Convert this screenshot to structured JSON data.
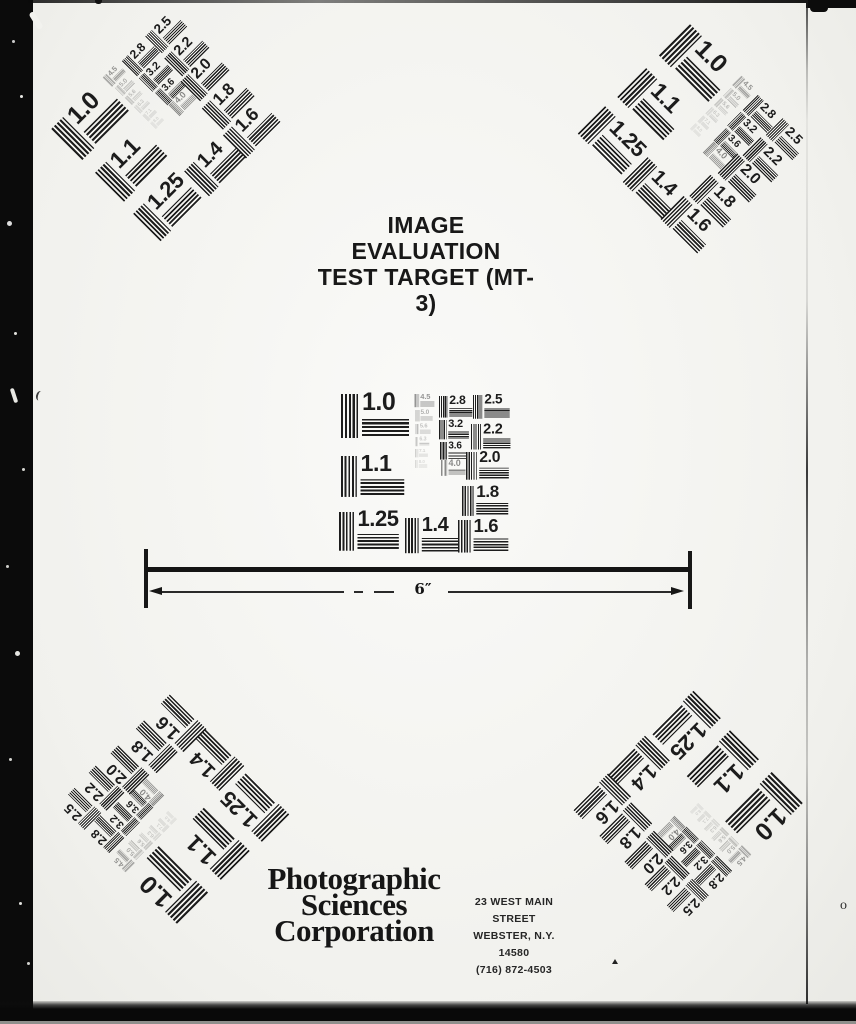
{
  "title": {
    "line1": "IMAGE EVALUATION",
    "line2": "TEST TARGET (MT-3)"
  },
  "ruler": {
    "label": "6″"
  },
  "footer": {
    "company_lines": [
      "Photographic",
      "Sciences",
      "Corporation"
    ],
    "address_lines": [
      "23 WEST MAIN STREET",
      "WEBSTER, N.Y. 14580",
      "(716) 872-4503"
    ]
  },
  "marks": {
    "stray_o": "o"
  },
  "colors": {
    "ink": "#1c1c1c",
    "paper": "#f5f5f1",
    "film_edge": "#0b0b0b"
  },
  "test_pattern": {
    "description": "resolution-wedge cells: value label with vertical and horizontal line bars",
    "cells": [
      {
        "value": "1.0",
        "x": 3,
        "y": 4,
        "s": 1.0
      },
      {
        "value": "1.1",
        "x": 3,
        "y": 66,
        "s": 0.93
      },
      {
        "value": "1.25",
        "x": 1,
        "y": 122,
        "s": 0.88
      },
      {
        "value": "1.4",
        "x": 67,
        "y": 128,
        "s": 0.8
      },
      {
        "value": "1.6",
        "x": 120,
        "y": 130,
        "s": 0.74
      },
      {
        "value": "1.8",
        "x": 124,
        "y": 96,
        "s": 0.68
      },
      {
        "value": "2.0",
        "x": 128,
        "y": 62,
        "s": 0.63
      },
      {
        "value": "2.2",
        "x": 133,
        "y": 34,
        "s": 0.58
      },
      {
        "value": "2.5",
        "x": 135,
        "y": 5,
        "s": 0.54
      },
      {
        "value": "2.8",
        "x": 101,
        "y": 6,
        "s": 0.49
      },
      {
        "value": "3.2",
        "x": 101,
        "y": 30,
        "s": 0.44
      },
      {
        "value": "3.6",
        "x": 102,
        "y": 52,
        "s": 0.4
      },
      {
        "value": "4.0",
        "x": 103,
        "y": 70,
        "s": 0.36,
        "o": 0.5
      },
      {
        "value": "4.5",
        "x": 76,
        "y": 4,
        "s": 0.3,
        "o": 0.45
      },
      {
        "value": "5.0",
        "x": 77,
        "y": 20,
        "s": 0.26,
        "o": 0.33
      },
      {
        "value": "5.6",
        "x": 77,
        "y": 34,
        "s": 0.23,
        "o": 0.27
      },
      {
        "value": "6.3",
        "x": 77,
        "y": 47,
        "s": 0.21,
        "o": 0.22
      },
      {
        "value": "7.1",
        "x": 77,
        "y": 59,
        "s": 0.19,
        "o": 0.18
      },
      {
        "value": "8.0",
        "x": 77,
        "y": 70,
        "s": 0.18,
        "o": 0.14
      }
    ]
  },
  "targets": [
    {
      "name": "top-left",
      "cx": 160,
      "cy": 122,
      "rotation": -45
    },
    {
      "name": "top-right",
      "cx": 697,
      "cy": 133,
      "rotation": 45
    },
    {
      "name": "center",
      "cx": 423,
      "cy": 466,
      "rotation": 0
    },
    {
      "name": "bottom-left",
      "cx": 170,
      "cy": 815,
      "rotation": -135
    },
    {
      "name": "bottom-right",
      "cx": 694,
      "cy": 810,
      "rotation": 135
    }
  ]
}
